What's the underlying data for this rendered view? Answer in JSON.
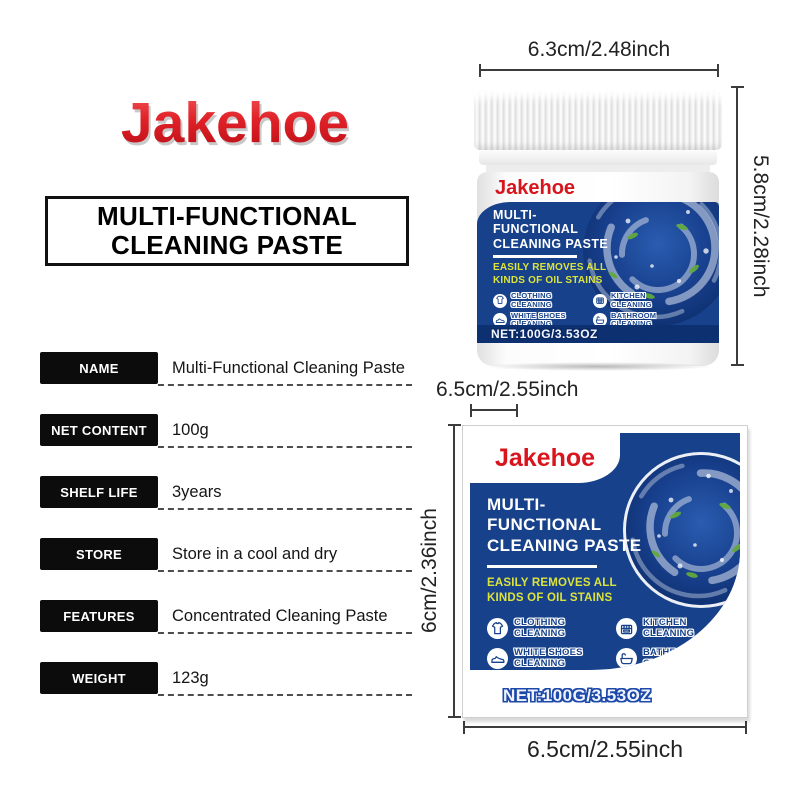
{
  "brand": "Jakehoe",
  "heading": {
    "line1": "MULTI-FUNCTIONAL",
    "line2": "CLEANING PASTE"
  },
  "specs": {
    "rows": [
      {
        "label": "NAME",
        "value": "Multi-Functional Cleaning Paste"
      },
      {
        "label": "NET CONTENT",
        "value": "100g"
      },
      {
        "label": "SHELF LIFE",
        "value": "3years"
      },
      {
        "label": "STORE",
        "value": "Store in a cool and dry"
      },
      {
        "label": "FEATURES",
        "value": "Concentrated Cleaning Paste"
      },
      {
        "label": "WEIGHT",
        "value": "123g"
      }
    ]
  },
  "label": {
    "title_line1": "MULTI-",
    "title_line2": "FUNCTIONAL",
    "title_line3": "CLEANING PASTE",
    "subtitle_line1": "EASILY REMOVES ALL",
    "subtitle_line2": "KINDS OF OIL STAINS",
    "features": [
      {
        "icon": "tshirt-icon",
        "line1": "CLOTHING",
        "line2": "CLEANING"
      },
      {
        "icon": "stove-icon",
        "line1": "KITCHEN",
        "line2": "CLEANING"
      },
      {
        "icon": "sneaker-icon",
        "line1": "WHITE SHOES",
        "line2": "CLEANING"
      },
      {
        "icon": "bathtub-icon",
        "line1": "BATHROOM",
        "line2": "CLEANING"
      }
    ],
    "net": "NET:100G/3.53OZ"
  },
  "dimensions": {
    "jar_width": "6.3cm/2.48inch",
    "jar_height": "5.8cm/2.28inch",
    "box_width_top": "6.5cm/2.55inch",
    "box_height": "6cm/2.36inch",
    "box_width_bottom": "6.5cm/2.55inch"
  },
  "colors": {
    "brand_red": "#d8151c",
    "label_blue": "#17428b",
    "accent_yellow": "#dce33b",
    "net_band_blue": "#0d3070"
  }
}
